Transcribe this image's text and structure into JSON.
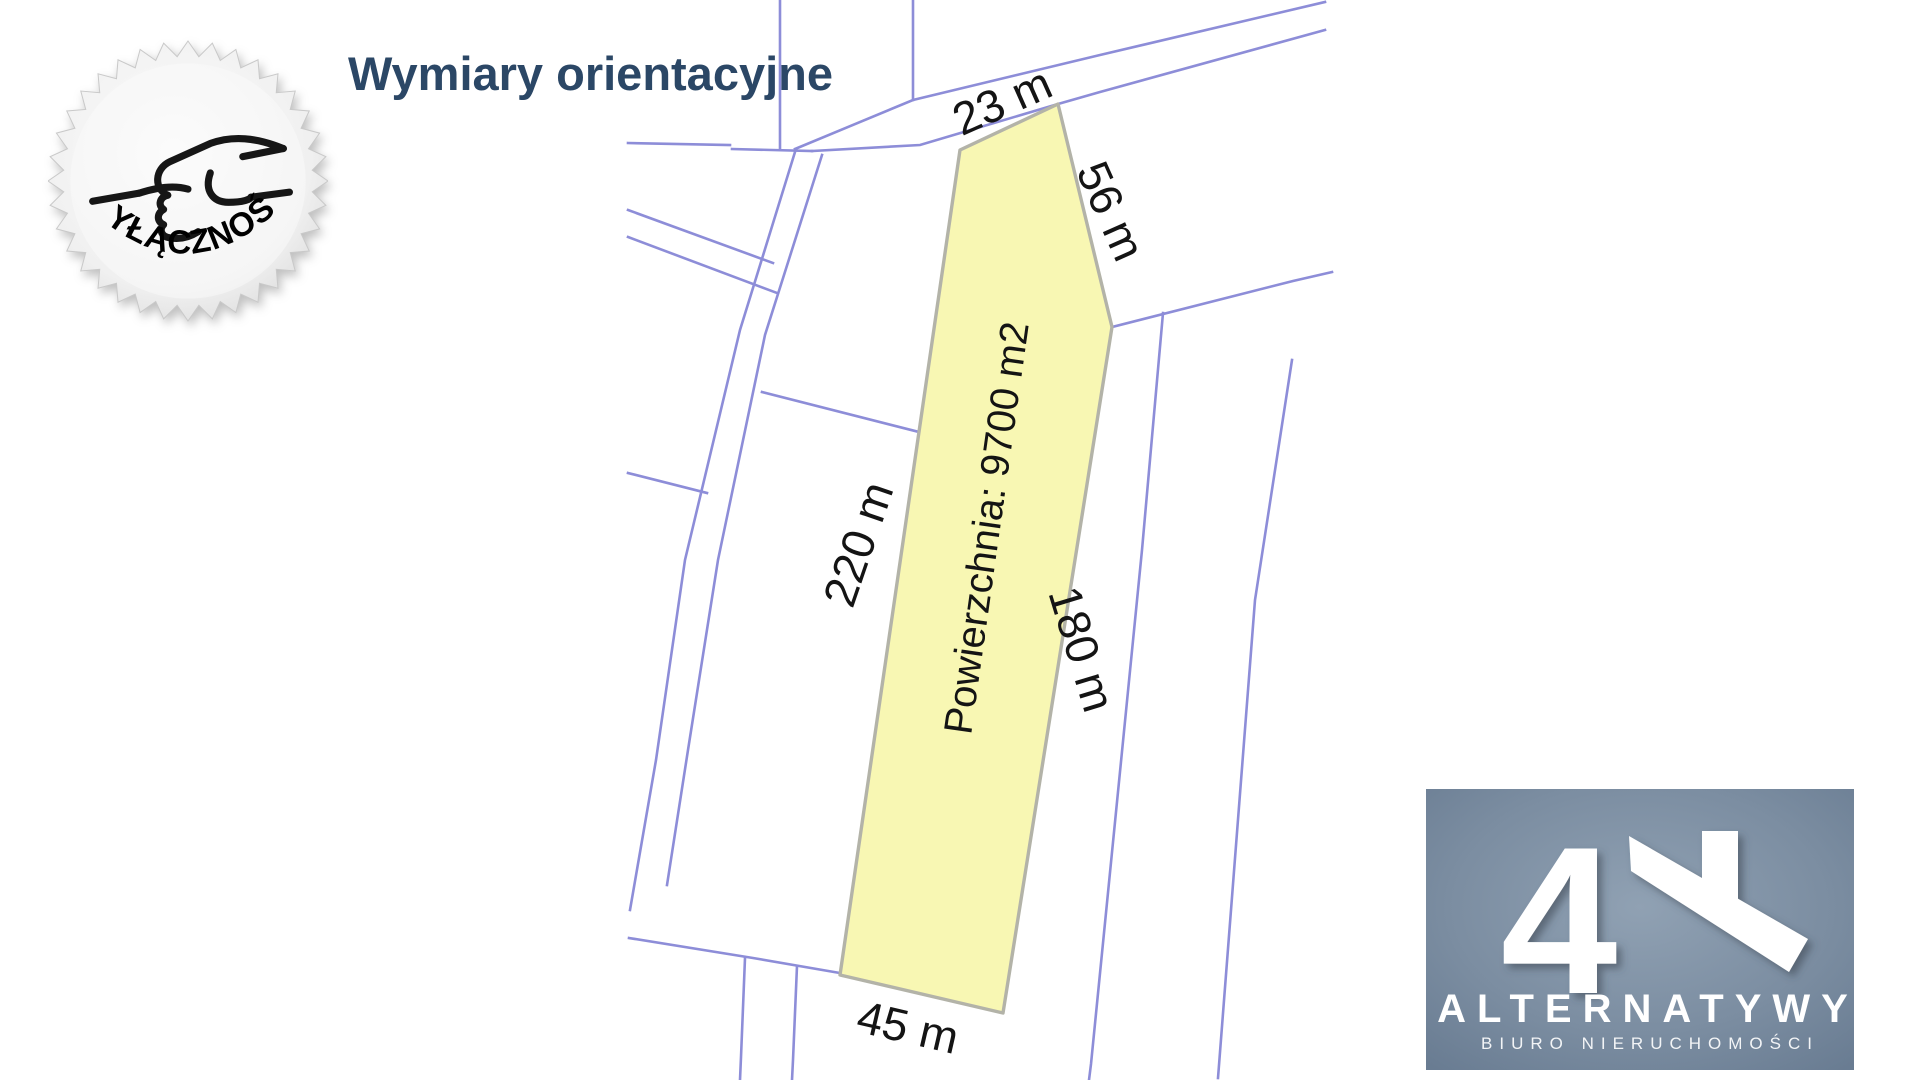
{
  "page": {
    "background": "#ffffff"
  },
  "header": {
    "title": "Wymiary orientacyjne",
    "title_color": "#2b4766"
  },
  "badge": {
    "label": "WYŁĄCZNOŚĆ",
    "icon": "handshake-icon"
  },
  "map": {
    "plot_fill": "#f8f7b3",
    "plot_border": "#b3b3a8",
    "parcel_line_color": "#8d8dd8",
    "area_label": "Powierzchnia: 9700 m2",
    "dimensions": {
      "top": "23 m",
      "upper_right": "56 m",
      "left": "220 m",
      "right": "180 m",
      "bottom": "45 m"
    }
  },
  "logo": {
    "numeral": "4",
    "name": "ALTERNATYWY",
    "subtitle": "BIURO NIERUCHOMOŚCI",
    "background": "#72849a"
  }
}
